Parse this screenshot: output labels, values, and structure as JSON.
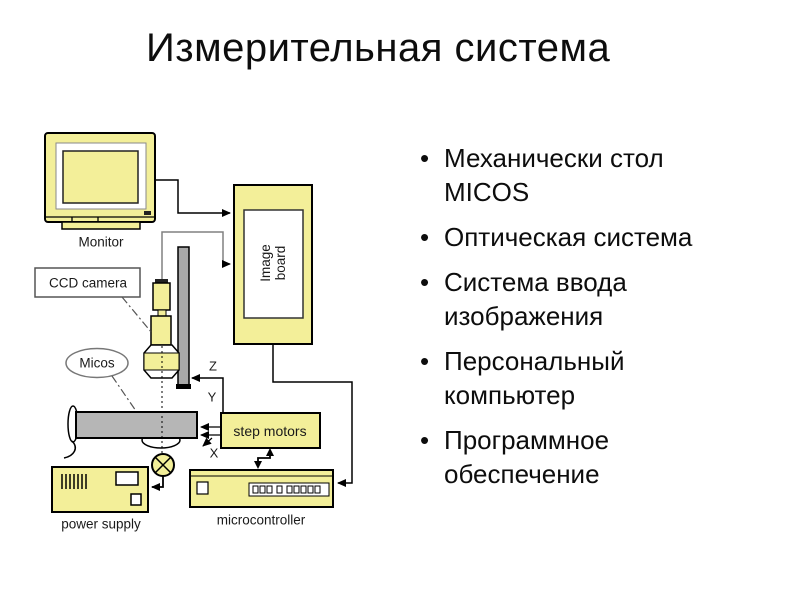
{
  "slide": {
    "title": "Измерительная система",
    "bullets": [
      "Механически стол\nMICOS",
      "Оптическая система",
      "Система ввода\nизображения",
      "Персональный\nкомпьютер",
      "Программное\nобеспечение"
    ]
  },
  "diagram": {
    "labels": {
      "monitor": "Monitor",
      "ccd_camera": "CCD camera",
      "micos": "Micos",
      "image_board": "Image\nboard",
      "step_motors": "step motors",
      "power_supply": "power supply",
      "microcontroller": "microcontroller",
      "axis_z": "Z",
      "axis_y": "Y",
      "axis_x": "X"
    },
    "colors": {
      "component_fill": "#f3ef99",
      "stage_gray": "#b6b6b6",
      "rail_gray": "#a8a8a8",
      "line_black": "#000000",
      "cable_gray": "#808080",
      "background": "#ffffff"
    }
  }
}
